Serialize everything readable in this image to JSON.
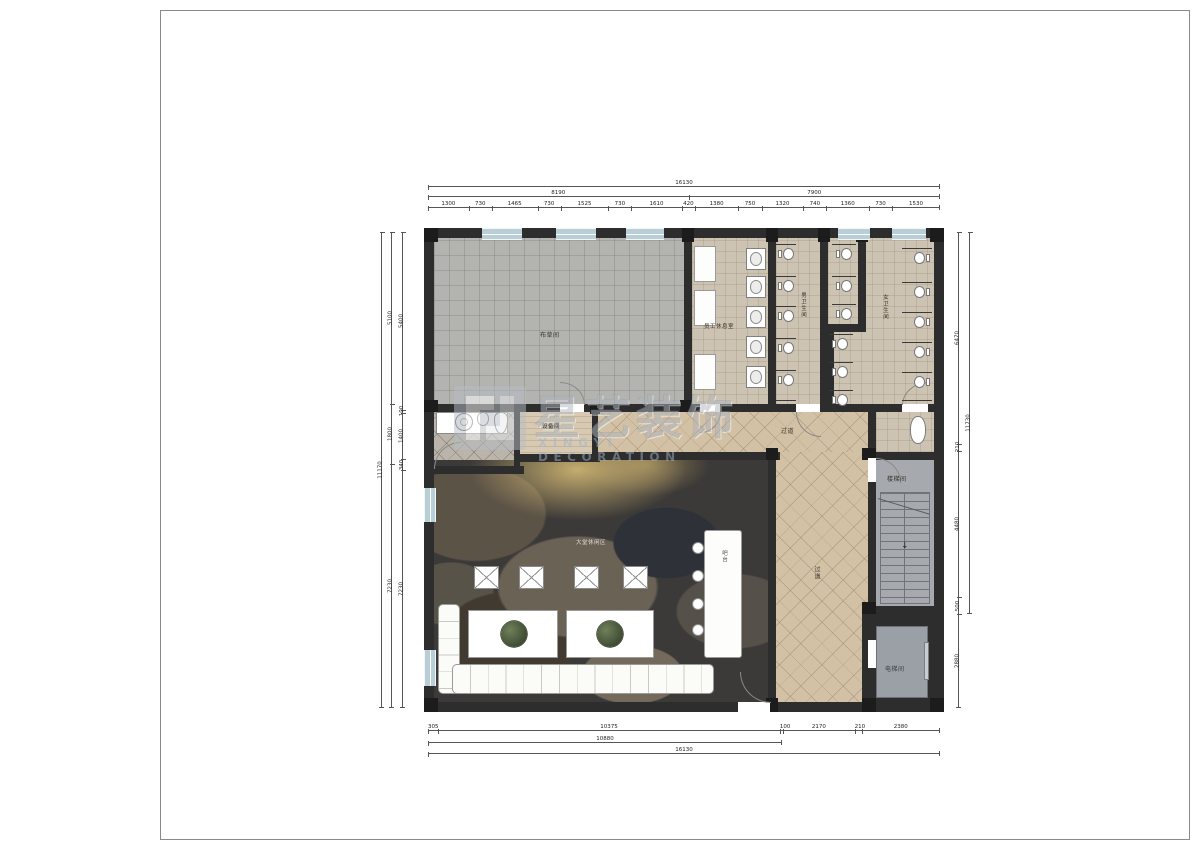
{
  "watermark": {
    "brand": "星艺装饰",
    "brand_en": "XINGYI DECORATION"
  },
  "rooms": {
    "linen": "布草间",
    "staff_lounge": "员工休息室",
    "mens_toilet": "男卫生间",
    "womens_toilet": "女卫生间",
    "equipment": "设备间",
    "corridor_h": "过道",
    "corridor_v": "过道",
    "bar": "吧台",
    "stair": "楼梯间",
    "elevator": "电梯间",
    "lounge_area": "大堂休闲区"
  },
  "dimensions": {
    "top_overall": "16130",
    "top_mid": [
      "8190",
      "7900"
    ],
    "top_inner": [
      "1300",
      "730",
      "1465",
      "730",
      "1525",
      "730",
      "1610",
      "420",
      "1380",
      "750",
      "1320",
      "740",
      "1360",
      "730",
      "1530"
    ],
    "bottom_inner": [
      "305",
      "10375",
      "100",
      "2170",
      "210",
      "2380"
    ],
    "bottom_mid": [
      "10880"
    ],
    "bottom_overall": "16130",
    "left_outer": "11170",
    "left_mid": [
      "5100",
      "1800",
      "7230"
    ],
    "left_inner": [
      "5400",
      "100",
      "1400",
      "340",
      "7230"
    ],
    "right_inner": [
      "6470",
      "210",
      "4480",
      "500",
      "2880"
    ],
    "right_outer": "11730"
  },
  "colors": {
    "wall": "#2d2d2d",
    "window": "#b9cfd8",
    "corridor_tile": "#d3c1a6",
    "toilet_tile": "#cdc3b2",
    "linen_tile": "#b3b3b0",
    "lobby_floor": "#3c3a38",
    "stair_floor": "#a6a9ad",
    "watermark_gray": "#aeb6be",
    "watermark_blue": "#9fb4cc"
  }
}
